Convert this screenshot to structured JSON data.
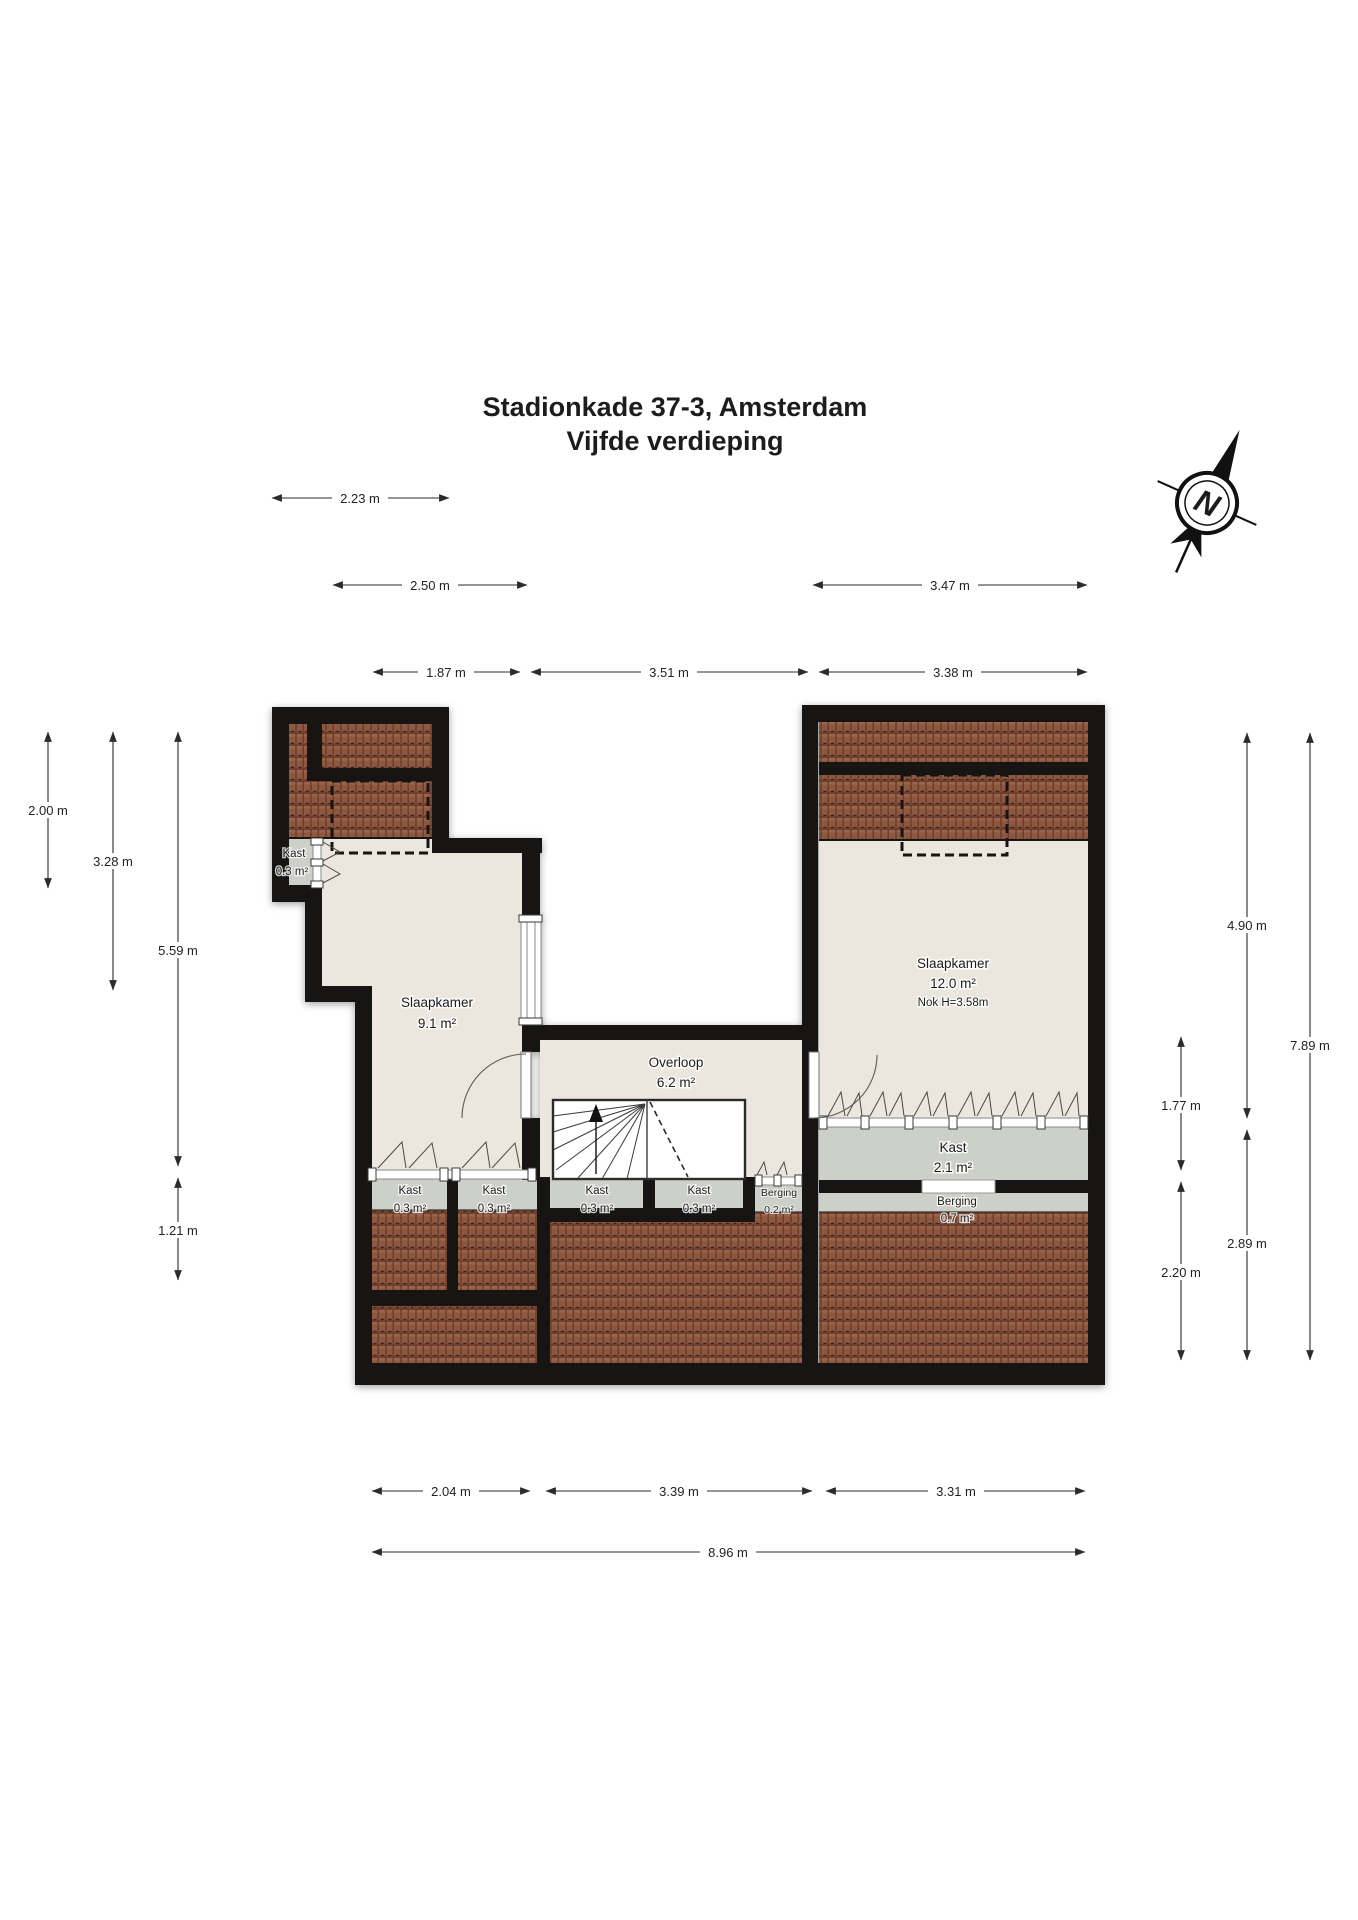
{
  "title": {
    "line1": "Stadionkade 37-3, Amsterdam",
    "line2": "Vijfde verdieping"
  },
  "compass": {
    "label": "N"
  },
  "rooms": {
    "kast_nw": {
      "name": "Kast",
      "area": "0.3 m²"
    },
    "slaapkamer_left": {
      "name": "Slaapkamer",
      "area": "9.1 m²"
    },
    "overloop": {
      "name": "Overloop",
      "area": "6.2 m²"
    },
    "slaapkamer_right": {
      "name": "Slaapkamer",
      "area": "12.0 m²",
      "note": "Nok H=3.58m"
    },
    "kast_s1": {
      "name": "Kast",
      "area": "0.3 m²"
    },
    "kast_s2": {
      "name": "Kast",
      "area": "0.3 m²"
    },
    "kast_s3": {
      "name": "Kast",
      "area": "0.3 m²"
    },
    "kast_s4": {
      "name": "Kast",
      "area": "0.3 m²"
    },
    "berging_small": {
      "name": "Berging",
      "area": "0.2 m²"
    },
    "kast_groot": {
      "name": "Kast",
      "area": "2.1 m²"
    },
    "berging": {
      "name": "Berging",
      "area": "0.7 m²"
    }
  },
  "dimensions": {
    "top": [
      {
        "label": "2.23 m"
      },
      {
        "label": "2.50 m"
      },
      {
        "label": "3.47 m"
      },
      {
        "label": "1.87 m"
      },
      {
        "label": "3.51 m"
      },
      {
        "label": "3.38 m"
      }
    ],
    "left": [
      {
        "label": "2.00 m"
      },
      {
        "label": "3.28 m"
      },
      {
        "label": "5.59 m"
      },
      {
        "label": "1.21 m"
      }
    ],
    "right": [
      {
        "label": "4.90 m"
      },
      {
        "label": "7.89 m"
      },
      {
        "label": "1.77 m"
      },
      {
        "label": "2.89 m"
      },
      {
        "label": "2.20 m"
      }
    ],
    "bottom": [
      {
        "label": "2.04 m"
      },
      {
        "label": "3.39 m"
      },
      {
        "label": "3.31 m"
      },
      {
        "label": "8.96 m"
      }
    ]
  },
  "colors": {
    "wall": "#161513",
    "floor": "#ebe7de",
    "closet_floor": "#ccd0c8",
    "roof_tile": "#8e573f",
    "roof_tile_dark": "#3f241a",
    "background": "#ffffff",
    "dimension_text": "#222222"
  }
}
